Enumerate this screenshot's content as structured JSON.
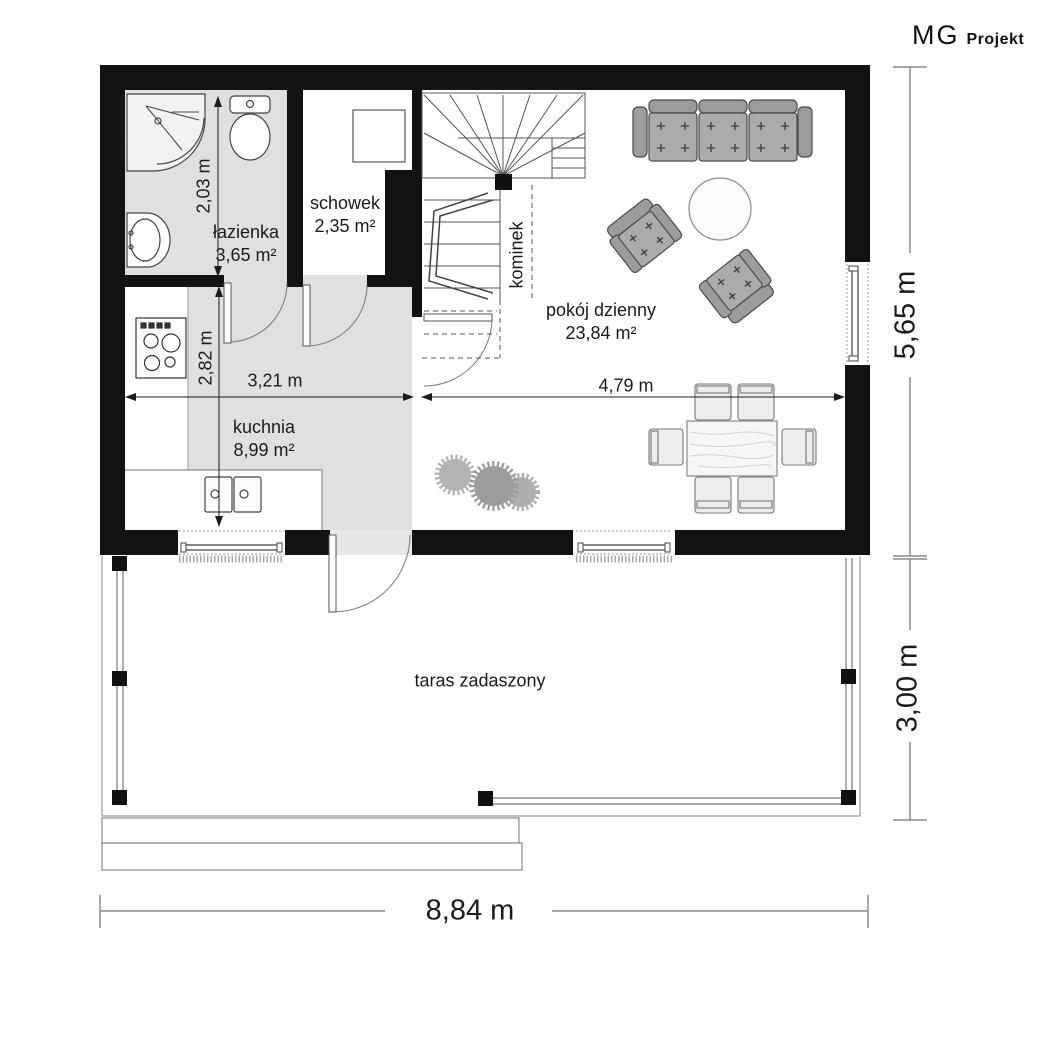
{
  "logo": {
    "brand": "MG",
    "suffix": "Projekt"
  },
  "rooms": {
    "lazienka": {
      "name": "łazienka",
      "area": "3,65 m²"
    },
    "schowek": {
      "name": "schowek",
      "area": "2,35 m²"
    },
    "kuchnia": {
      "name": "kuchnia",
      "area": "8,99 m²"
    },
    "pokoj_dzienny": {
      "name": "pokój dzienny",
      "area": "23,84 m²"
    },
    "kominek": {
      "name": "kominek"
    },
    "taras": {
      "name": "taras zadaszony"
    }
  },
  "dimensions": {
    "bathroom_depth": "2,03 m",
    "kitchen_depth": "2,82 m",
    "kitchen_width": "3,21 m",
    "living_width": "4,79 m",
    "house_depth": "5,65 m",
    "terrace_depth": "3,00 m",
    "house_width": "8,84 m"
  },
  "colors": {
    "wall": "#121212",
    "floor_gray": "#e0e0e0",
    "furniture_gray": "#a9a9a9",
    "dim_line_gray": "#8a8a8a",
    "text": "#1b1b1b"
  }
}
